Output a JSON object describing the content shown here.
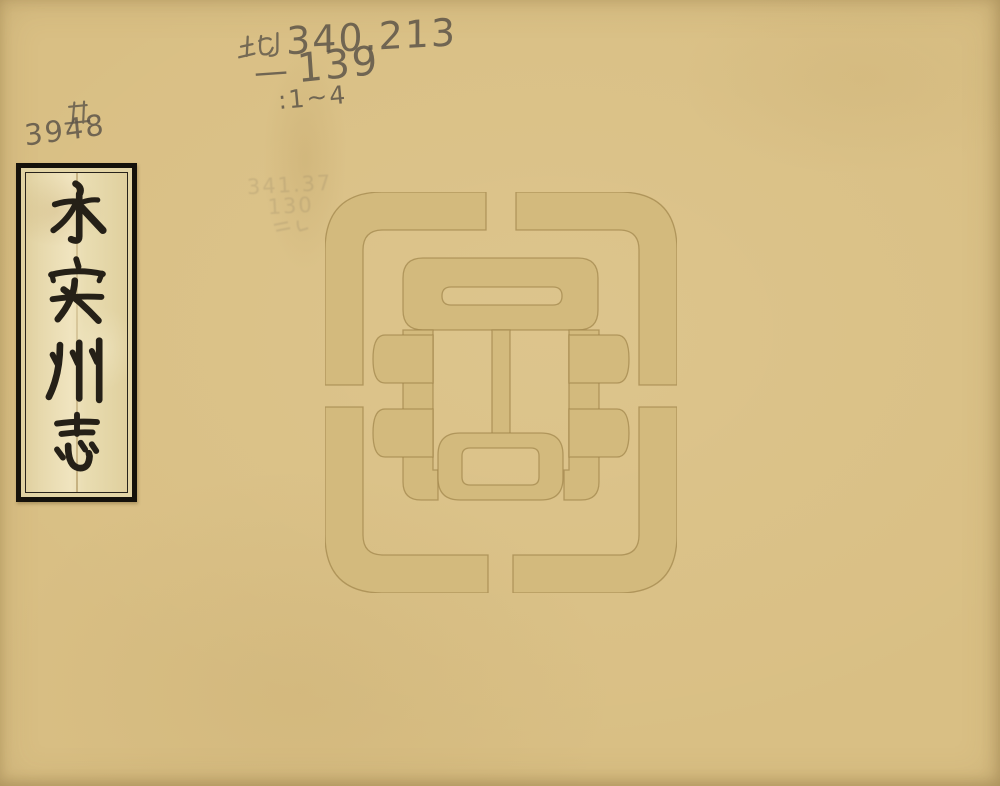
{
  "cover": {
    "spine_label": {
      "title": "永安州志",
      "title_chars": [
        "永",
        "安",
        "州",
        "志"
      ]
    },
    "pencil_annotations": {
      "call_number_prefix_char": "地",
      "call_number_class": "340.213",
      "dash": "—",
      "call_number_item": "139",
      "volume_range": ":1~4",
      "corner_char": "丑",
      "corner_number": "3948",
      "erased_marks": [
        "341.37",
        "130",
        "剩二"
      ]
    },
    "watermark": {
      "name": "national-library-logo",
      "style": "embossed outline, barely darker than cover"
    },
    "colors": {
      "cover_background": "#d9bf84",
      "label_paper": "#ece0b6",
      "label_frame": "#14110b",
      "ink": "#252017",
      "pencil": "#5f574a",
      "watermark_fill": "#d3ba7d",
      "watermark_outline": "#a0844a"
    }
  }
}
